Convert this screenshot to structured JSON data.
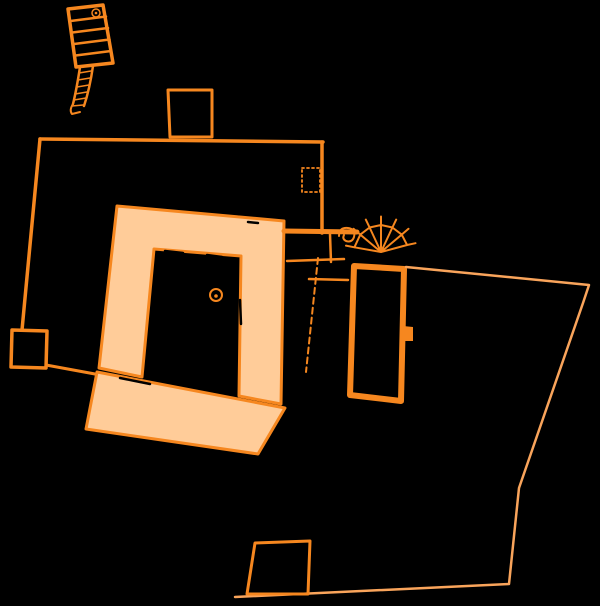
{
  "page": {
    "background_color": "#000000"
  },
  "plan": {
    "canvas": {
      "width": 600,
      "height": 606
    },
    "colors": {
      "outline": "#F6871F",
      "fill": "#FFCC99",
      "boundary": "#F9A45B",
      "damage": "#000000"
    },
    "shapes": [
      {
        "name": "stair-building-outline",
        "type": "path",
        "d": "M68,9 L103,5 L113,63 L76,67 Z",
        "stroke": "outline",
        "width": 3.5
      },
      {
        "name": "stair-building-steps",
        "type": "path",
        "d": "M70.5,21 L106,16.5 M72.3,32.5 L108,28 M74,44 L109.5,39.5 M75.6,55.5 L111,51",
        "stroke": "outline",
        "width": 2.5
      },
      {
        "name": "stair-turret-symbol",
        "type": "circle",
        "cx": 96,
        "cy": 13,
        "r": 4,
        "stroke": "outline",
        "width": 1.5
      },
      {
        "name": "stair-turret-symbol-dot",
        "type": "circle",
        "cx": 96,
        "cy": 13,
        "r": 1.3,
        "fill": "outline"
      },
      {
        "name": "ramp-passage-walls",
        "type": "path",
        "d": "M80,67 C78,80 76,92 73,104 M93,66 C91,80 88,94 84,106",
        "stroke": "outline",
        "width": 2.5
      },
      {
        "name": "ramp-hatching",
        "type": "path",
        "d": "M79,73 L91,71 M78,80 L90,78 M77,87 L89,85 M75,94 L87,92 M74,100 L86,98 M72,106 L83,105",
        "stroke": "outline",
        "width": 1.5
      },
      {
        "name": "ramp-end-hook",
        "type": "path",
        "d": "M73,104 Q69,110 72,114 L80,112",
        "stroke": "outline",
        "width": 2
      },
      {
        "name": "enclosure-top-wall",
        "type": "line",
        "x1": 40,
        "y1": 139,
        "x2": 323,
        "y2": 142,
        "stroke": "outline",
        "width": 3.5
      },
      {
        "name": "enclosure-left-wall",
        "type": "line",
        "x1": 40,
        "y1": 139,
        "x2": 22,
        "y2": 330,
        "stroke": "outline",
        "width": 3.5
      },
      {
        "name": "enclosure-right-wall",
        "type": "line",
        "x1": 322,
        "y1": 142,
        "x2": 322,
        "y2": 233,
        "stroke": "outline",
        "width": 3.5
      },
      {
        "name": "gate-tower",
        "type": "path",
        "d": "M168,90 L212,90 L212,137 L170,137 Z",
        "stroke": "outline",
        "width": 3
      },
      {
        "name": "dotted-chamber",
        "type": "path",
        "d": "M302,168 L320,168 L320,192 L302,192 Z",
        "stroke": "outline",
        "width": 1.8,
        "dash": "2,3"
      },
      {
        "name": "west-annex",
        "type": "path",
        "d": "M12,330 L47,331 L46,368 L11,367 Z",
        "stroke": "outline",
        "width": 3.5
      },
      {
        "name": "annex-link-wall",
        "type": "line",
        "x1": 46,
        "y1": 365,
        "x2": 133,
        "y2": 381,
        "stroke": "outline",
        "width": 3
      },
      {
        "name": "cloister-ranges",
        "type": "path",
        "d": "M117,206 L284,221 L281,404 L239,396 L241,256 L154,249 L142,377 L99,368 Z",
        "stroke": "outline",
        "fill": "fill",
        "width": 3
      },
      {
        "name": "south-wing",
        "type": "path",
        "d": "M97,372 L285,408 L258,454 L86,429 Z",
        "stroke": "outline",
        "fill": "fill",
        "width": 3
      },
      {
        "name": "well-symbol",
        "type": "circle",
        "cx": 216,
        "cy": 295,
        "r": 6,
        "stroke": "outline",
        "width": 2
      },
      {
        "name": "well-symbol-dot",
        "type": "circle",
        "cx": 216,
        "cy": 296,
        "r": 1.8,
        "fill": "outline"
      },
      {
        "name": "great-hall",
        "type": "path",
        "d": "M354,266 L404,269 L401,401 L350,395 Z",
        "stroke": "outline",
        "width": 6
      },
      {
        "name": "hall-buttress",
        "type": "path",
        "d": "M403,326 L413,327 L413,341 L403,341 Z",
        "fill": "outline"
      },
      {
        "name": "spiral-stair-fan",
        "type": "path",
        "d": "M354.4,247.3 L360.3,234.6 L369.6,227.5 L381,225 L392.4,227.5 L401.7,234.6 L407.1,245 M381,252 L354.4,247.3 M381,252 L360.3,234.6 M381,252 L369.6,227.5 M381,252 L381,225 M381,252 L392.4,227.5 M381,252 L401.7,234.6 M381,252 L407.1,245 M360.3,234.6 L353.5,228.8 M369.6,227.5 L365.8,219.6 M381,225 L381,216.5 M392.4,227.5 L396.2,219.6 M401.7,234.6 L408.5,228.8 M407.1,245 L415.5,243.2 M354.4,247.3 L346,245.6",
        "stroke": "outline",
        "width": 2
      },
      {
        "name": "stair-scroll",
        "type": "path",
        "d": "M339,236 Q339,227 348,228 Q356,229 354,237 Q352,243 346,241 Q342,239 344,235",
        "stroke": "outline",
        "width": 2
      },
      {
        "name": "courtyard-link-upper",
        "type": "line",
        "x1": 284,
        "y1": 231,
        "x2": 357,
        "y2": 232,
        "stroke": "outline",
        "width": 5
      },
      {
        "name": "courtyard-link-mid",
        "type": "line",
        "x1": 287,
        "y1": 261,
        "x2": 344,
        "y2": 259,
        "stroke": "outline",
        "width": 2.5
      },
      {
        "name": "courtyard-link-lower",
        "type": "line",
        "x1": 309,
        "y1": 279,
        "x2": 348,
        "y2": 280,
        "stroke": "outline",
        "width": 2.5
      },
      {
        "name": "courtyard-link-vertical",
        "type": "line",
        "x1": 330,
        "y1": 234,
        "x2": 331,
        "y2": 262,
        "stroke": "outline",
        "width": 2.5
      },
      {
        "name": "inner-wall-dashed",
        "type": "line",
        "x1": 318,
        "y1": 258,
        "x2": 306,
        "y2": 372,
        "stroke": "outline",
        "width": 2,
        "dash": "6,4"
      },
      {
        "name": "precinct-boundary",
        "type": "path",
        "d": "M406,267 L589,285 L583,303 L519,488 L509,584 L235,597",
        "stroke": "boundary",
        "width": 2.5
      },
      {
        "name": "south-building",
        "type": "path",
        "d": "M255,543 L310,541 L308,594 L247,594 Z",
        "stroke": "outline",
        "width": 3
      },
      {
        "name": "fill-damage-marks",
        "type": "path",
        "d": "M165,251 L183,253 M207,255 L222,257 M227,212 L239,214 M240,300 L241,324 M120,378 L150,384 M248,222 L258,223",
        "stroke": "damage",
        "width": 2.5
      }
    ]
  }
}
